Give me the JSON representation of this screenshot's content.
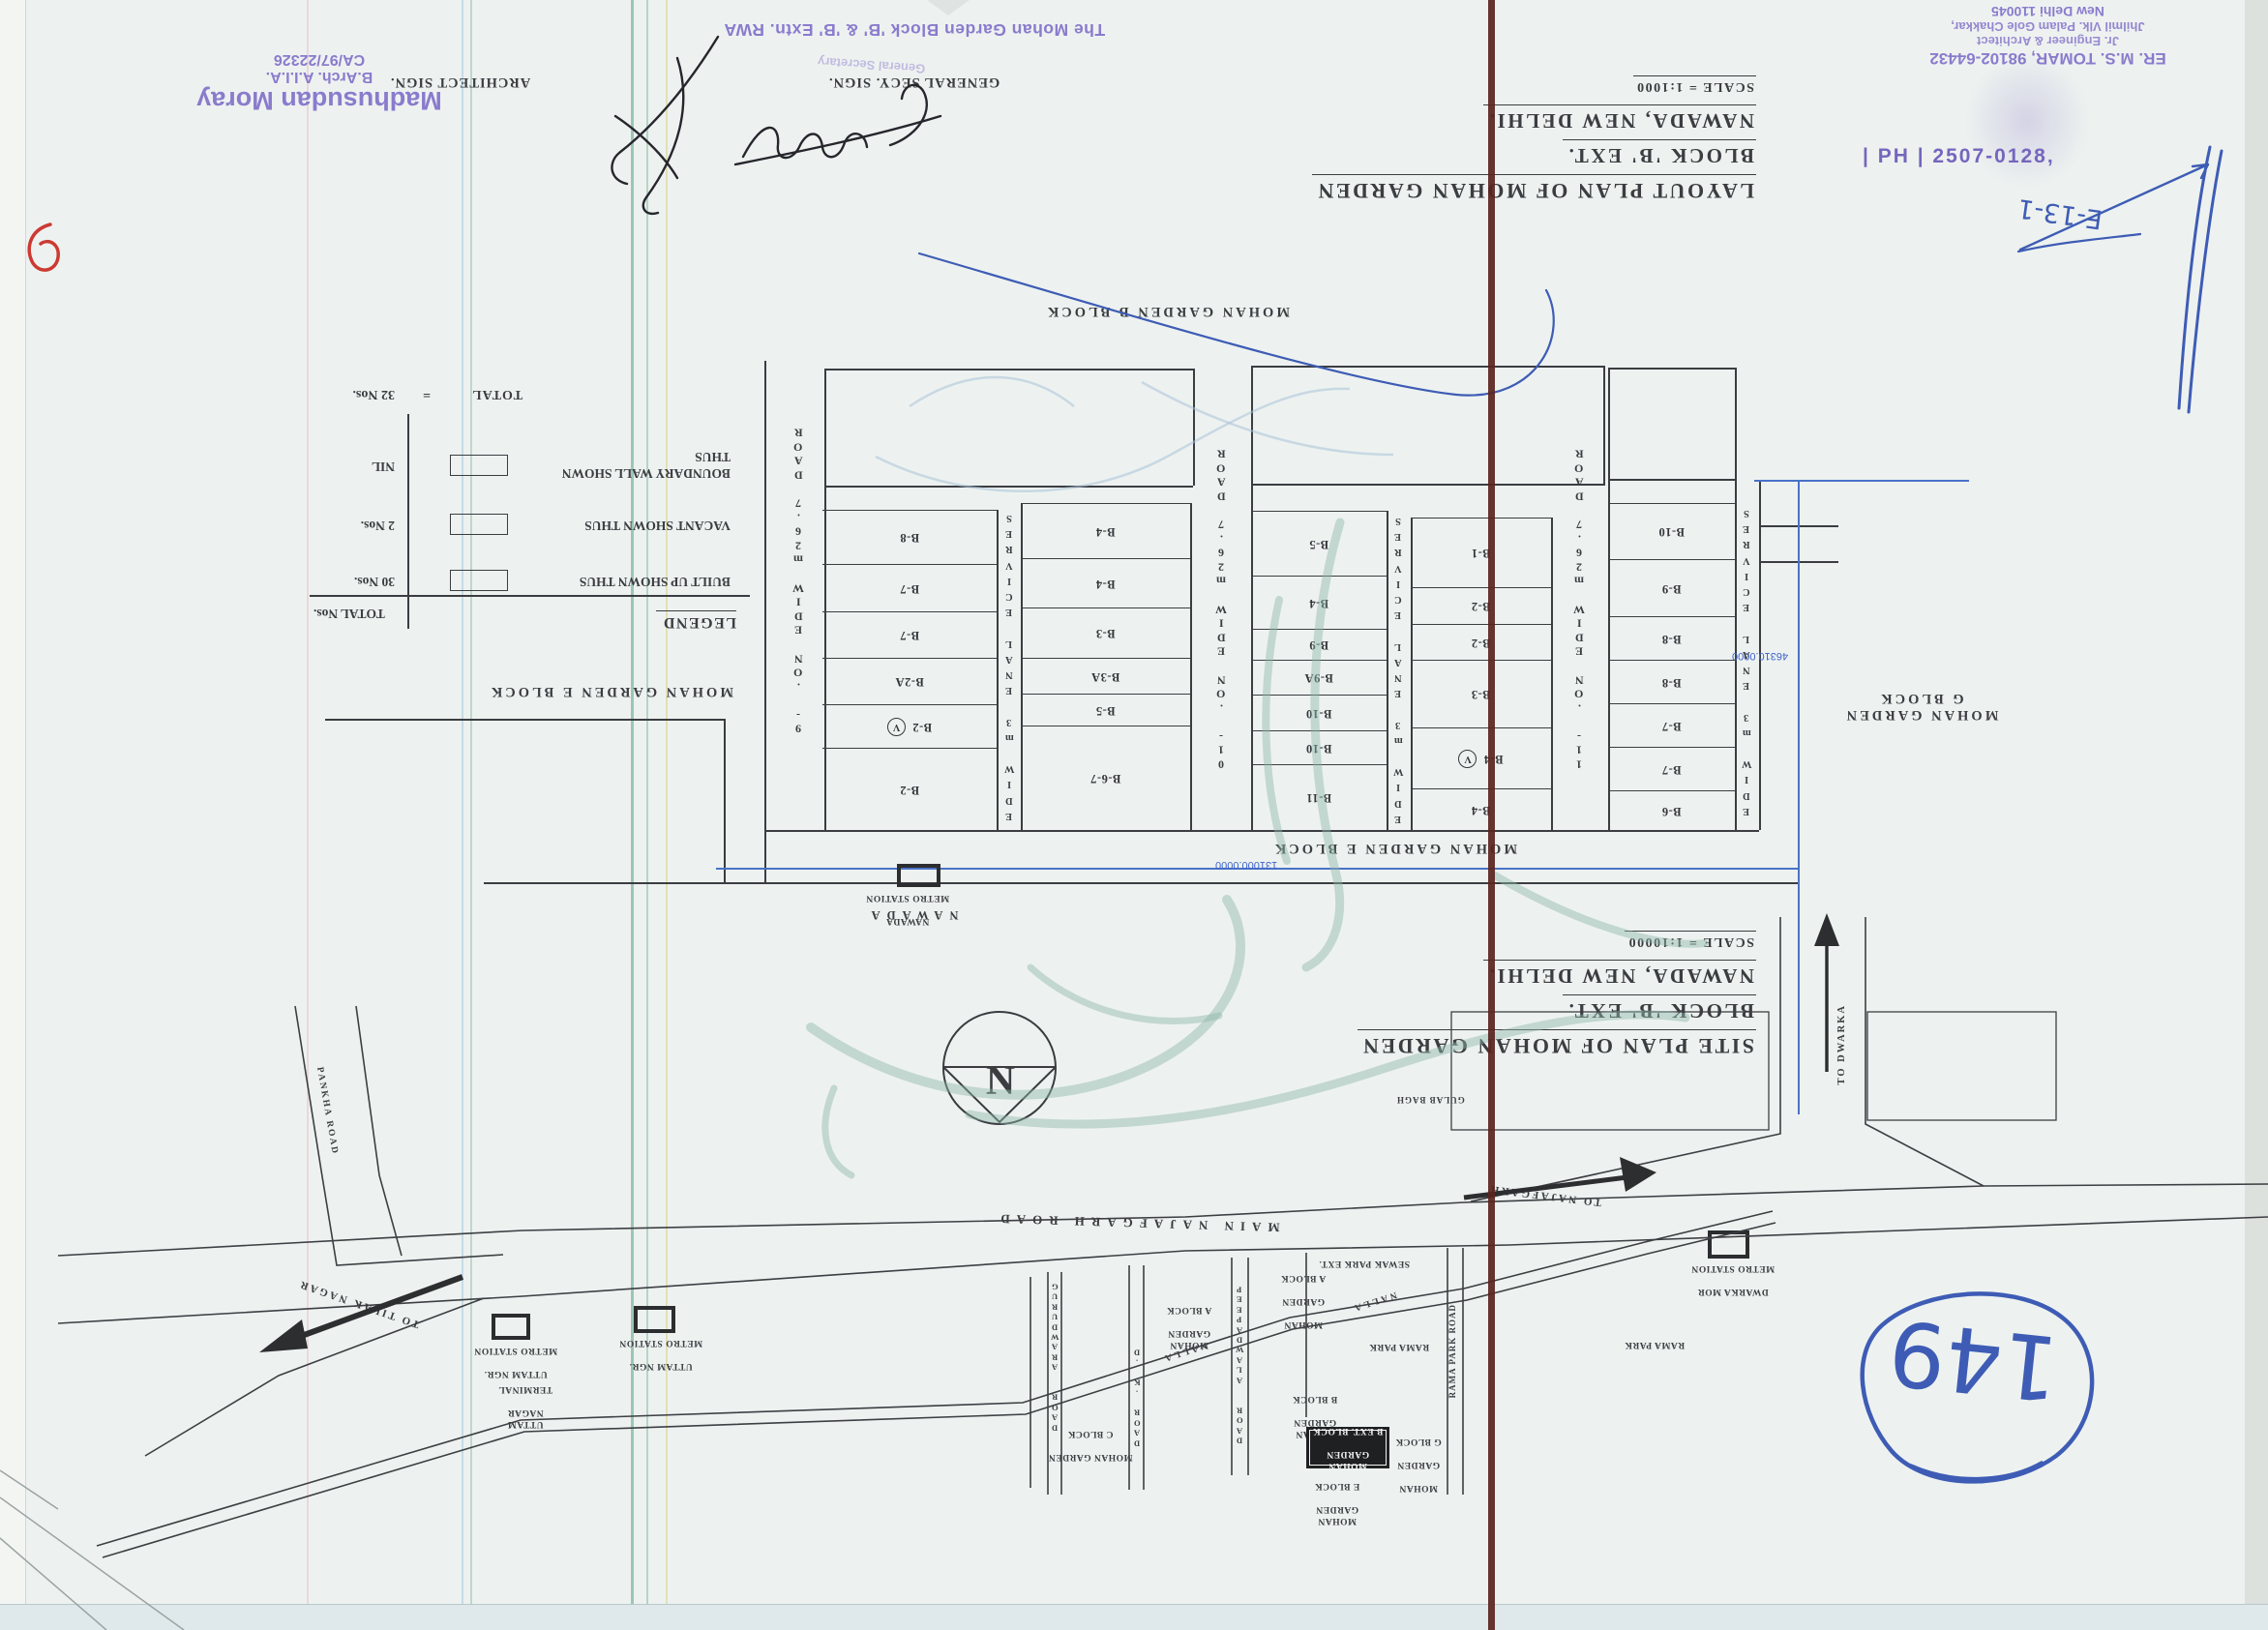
{
  "signatures": {
    "architect_sign_label": "ARCHITECT SIGN.",
    "architect_stamp": {
      "name": "Madhusudan Moray",
      "degree": "B.Arch. A.I.I.A.",
      "reg_no": "CA/97/22326"
    },
    "general_secy_sign_label": "GENERAL SECY. SIGN.",
    "secy_ghost_stamp": "General Secretary",
    "rwa_stamp": "The Mohan Garden Block 'B' & 'B' Extn. RWA",
    "engineer_stamp": {
      "line1": "ER. M.S. TOMAR, 98102-64432",
      "line2": "Jr. Engineer & Architect",
      "line3": "Jhilmil Vlk. Palam Gole Chakkar,",
      "line4": "New Delhi 110045",
      "phone": "| PH | 2507-0128,"
    },
    "handwritten_note": "E-13-1",
    "page_number": "149"
  },
  "layout_plan": {
    "title_lines": [
      "LAYOUT PLAN OF MOHAN GARDEN",
      "BLOCK 'B' EXT.",
      "NAWADA, NEW DELHI."
    ],
    "scale": "SCALE = 1:1000",
    "block_north": "MOHAN GARDEN   B   BLOCK",
    "block_south": "MOHAN GARDEN   E   BLOCK",
    "block_west": "MOHAN GARDEN   E   BLOCK",
    "block_east_lines": [
      "MOHAN GARDEN",
      "G  BLOCK"
    ],
    "road_labels": [
      "ROAD 7.62m WIDE NO. -9",
      "ROAD 7.62m WIDE NO. -10",
      "ROAD 7.62m WIDE NO. -11"
    ],
    "service_lane": "SERVICE LANE 3m WIDE",
    "coord_south": "131000.0000",
    "coord_east": "46310.0000",
    "columns": [
      {
        "plots": [
          {
            "label": "B-8"
          },
          {
            "label": "B-7"
          },
          {
            "label": "B-7"
          },
          {
            "label": "B-2A"
          },
          {
            "label": "B-2",
            "vacant": true
          },
          {
            "label": "B-2"
          }
        ]
      },
      {
        "plots": [
          {
            "label": "B-4"
          },
          {
            "label": "B-4"
          },
          {
            "label": "B-3"
          },
          {
            "label": "B-3A"
          },
          {
            "label": "B-5"
          },
          {
            "label": "B-6-7"
          }
        ]
      },
      {
        "plots": [
          {
            "label": "B-5"
          },
          {
            "label": "B-4"
          },
          {
            "label": "B-9"
          },
          {
            "label": "B-9A"
          },
          {
            "label": "B-10"
          },
          {
            "label": "B-10"
          },
          {
            "label": "B-11"
          }
        ]
      },
      {
        "plots": [
          {
            "label": "B-1"
          },
          {
            "label": "B-2"
          },
          {
            "label": "B-2"
          },
          {
            "label": "B-3"
          },
          {
            "label": "B-4",
            "vacant": true
          },
          {
            "label": "B-4"
          }
        ]
      },
      {
        "plots": [
          {
            "label": "B-10"
          },
          {
            "label": "B-9"
          },
          {
            "label": "B-8"
          },
          {
            "label": "B-8"
          },
          {
            "label": "B-7"
          },
          {
            "label": "B-7"
          },
          {
            "label": "B-6"
          }
        ]
      }
    ]
  },
  "legend": {
    "title": "LEGEND",
    "col_header": "TOTAL Nos.",
    "rows": [
      {
        "label": "BUILT UP SHOWN THUS",
        "value": "30 Nos."
      },
      {
        "label": "VACANT SHOWN THUS",
        "value": "2 Nos."
      },
      {
        "label": "BOUNDARY WALL SHOWN\nTHUS",
        "value": "NIL"
      }
    ],
    "total_label": "TOTAL",
    "total_eq": "=",
    "total_value": "32 Nos."
  },
  "site_plan": {
    "title_lines": [
      "SITE PLAN OF MOHAN GARDEN",
      "BLOCK 'B' EXT.",
      "NAWADA, NEW DELHI."
    ],
    "scale": "SCALE = 1:10000",
    "north_letter": "N",
    "roads": {
      "main": "MAIN NAJAFGARH ROAD",
      "to_najafgarh": "TO NAJAFGARH",
      "to_tilak_nagar": "TO TILAK NAGAR",
      "to_dwarka": "TO DWARKA",
      "pankha": "PANKHA  ROAD",
      "gurudwara": "GURUDWARA  ROAD",
      "dk": "D. K. ROAD",
      "peepadwala": "PEEPADWALA  ROAD",
      "rama_park_road": "RAMA PARK ROAD",
      "nalla": "NALLA",
      "gulab_bagh": "GULAB BAGH"
    },
    "areas": {
      "sewak_park": "SEWAK PARK EXT.",
      "a_block1": [
        "MOHAN GARDEN",
        "A BLOCK"
      ],
      "a_block2": [
        "MOHAN",
        "GARDEN",
        "A BLOCK"
      ],
      "b_block": [
        "MOHAN GARDEN",
        "B BLOCK"
      ],
      "c_block": [
        "MOHAN GARDEN",
        "C BLOCK"
      ],
      "b_ext": [
        "MOHAN GARDEN",
        "B EXT. BLOCK"
      ],
      "g_block": [
        "MOHAN",
        "GARDEN",
        "G BLOCK"
      ],
      "e_block": [
        "MOHAN GARDEN",
        "E BLOCK"
      ],
      "rama_park1": "RAMA PARK",
      "rama_park2": "RAMA PARK"
    },
    "stations": {
      "uttam1": [
        "UTTAM NGR.",
        "METRO STATION"
      ],
      "uttam2": [
        "UTTAM NGR.",
        "METRO STATION"
      ],
      "terminal": [
        "UTTAM NAGAR",
        "TERMINAL"
      ],
      "nawada_station": [
        "NAWADA",
        "METRO STATION"
      ],
      "nawada_area": "NAWADA",
      "dwarka_mor": [
        "DWARKA MOR",
        "METRO STATION"
      ]
    }
  },
  "colors": {
    "stamp_purple": "#8a7bcd",
    "pen_blue": "#3e5cb5",
    "marker_teal": "#8fb5a8",
    "fold_brown": "#5a241e",
    "print_ink": "#3b3d41",
    "plan_blue": "#4a72c8",
    "mark_red": "#cc3a33"
  }
}
